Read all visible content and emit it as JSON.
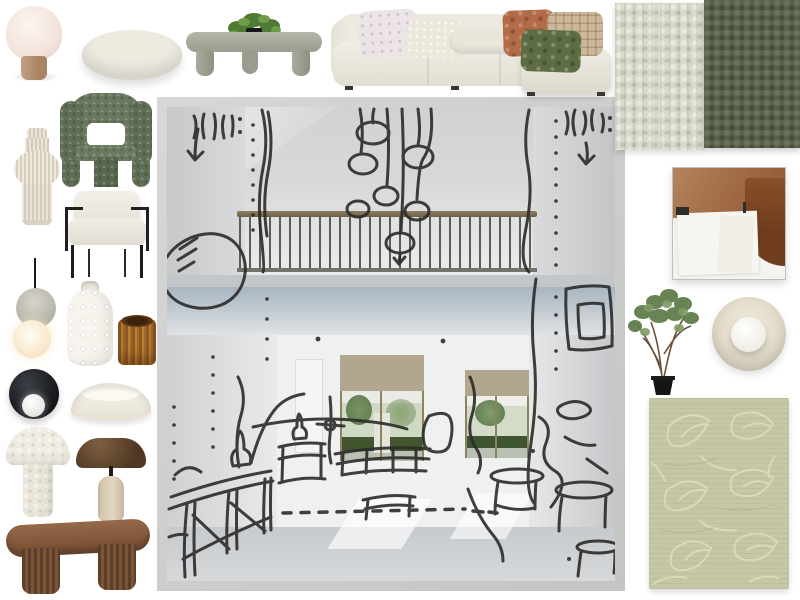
{
  "board": {
    "kind": "interior-design-moodboard-canvas",
    "background": "#ffffff",
    "items": [
      {
        "id": "table-lamp",
        "name": "dome table lamp with wood base",
        "rect": {
          "x": 3,
          "y": 6,
          "w": 62,
          "h": 76
        }
      },
      {
        "id": "ottoman",
        "name": "round boucle ottoman",
        "rect": {
          "x": 82,
          "y": 30,
          "w": 100,
          "h": 50
        }
      },
      {
        "id": "coffee-table",
        "name": "square concrete coffee table with plant",
        "rect": {
          "x": 186,
          "y": 10,
          "w": 136,
          "h": 66
        }
      },
      {
        "id": "sofa",
        "name": "cream modular sofa with cushions and chaise",
        "rect": {
          "x": 331,
          "y": 4,
          "w": 281,
          "h": 92
        }
      },
      {
        "id": "swatch-light",
        "name": "light boucle fabric swatch",
        "rect": {
          "x": 615,
          "y": 3,
          "w": 89,
          "h": 147
        }
      },
      {
        "id": "swatch-olive",
        "name": "olive boucle fabric swatch",
        "rect": {
          "x": 704,
          "y": 0,
          "w": 96,
          "h": 148
        }
      },
      {
        "id": "artwork",
        "name": "abstract framed artwork brown and white",
        "rect": {
          "x": 672,
          "y": 167,
          "w": 112,
          "h": 111
        }
      },
      {
        "id": "tree",
        "name": "potted indoor tree",
        "rect": {
          "x": 621,
          "y": 282,
          "w": 84,
          "h": 114
        }
      },
      {
        "id": "sconce",
        "name": "round cream wall sconce with sphere",
        "rect": {
          "x": 712,
          "y": 297,
          "w": 74,
          "h": 74
        }
      },
      {
        "id": "rug",
        "name": "sage green leaf pattern rug",
        "rect": {
          "x": 649,
          "y": 398,
          "w": 140,
          "h": 191
        }
      },
      {
        "id": "vase-ribbed",
        "name": "cream pleated sculptural vase",
        "rect": {
          "x": 14,
          "y": 128,
          "w": 46,
          "h": 97
        }
      },
      {
        "id": "chair-green",
        "name": "green boucle sculptural armchair",
        "rect": {
          "x": 60,
          "y": 93,
          "w": 92,
          "h": 94
        }
      },
      {
        "id": "chair-white",
        "name": "white armchair with black metal frame",
        "rect": {
          "x": 62,
          "y": 191,
          "w": 90,
          "h": 87
        }
      },
      {
        "id": "pendant",
        "name": "double sphere pendant light",
        "rect": {
          "x": 13,
          "y": 258,
          "w": 44,
          "h": 104
        }
      },
      {
        "id": "vase-dotted",
        "name": "white dotted ceramic vase",
        "rect": {
          "x": 67,
          "y": 281,
          "w": 46,
          "h": 85
        }
      },
      {
        "id": "candle",
        "name": "amber ribbed glass candle holder",
        "rect": {
          "x": 118,
          "y": 315,
          "w": 38,
          "h": 50
        }
      },
      {
        "id": "wall-light-black",
        "name": "black disc wall light with white globe",
        "rect": {
          "x": 9,
          "y": 369,
          "w": 50,
          "h": 50
        }
      },
      {
        "id": "bowl",
        "name": "organic white decorative bowl",
        "rect": {
          "x": 71,
          "y": 379,
          "w": 80,
          "h": 42
        }
      },
      {
        "id": "lamp-mushroom-white",
        "name": "white boucle mushroom lamp",
        "rect": {
          "x": 6,
          "y": 427,
          "w": 64,
          "h": 92
        }
      },
      {
        "id": "lamp-mushroom-brown",
        "name": "bronze mushroom lamp with travertine base",
        "rect": {
          "x": 76,
          "y": 434,
          "w": 70,
          "h": 88
        }
      },
      {
        "id": "bench",
        "name": "walnut fluted oval bench",
        "rect": {
          "x": 6,
          "y": 514,
          "w": 144,
          "h": 82
        }
      },
      {
        "id": "render",
        "name": "double height living room render with marker sketch overlay",
        "rect": {
          "x": 157,
          "y": 97,
          "w": 468,
          "h": 494
        }
      }
    ]
  },
  "palette": {
    "background": "#ffffff",
    "sketch_ink": "#2b2b29",
    "sofa_cream": "#edeae1",
    "swatch_light": "#d9d9cd",
    "swatch_olive": "#59614c",
    "chair_green": "#66755b",
    "terracotta_cushion": "#b26a47",
    "green_cushion": "#5d6c44",
    "amber_glass": "#a06a28",
    "walnut": "#74513a",
    "travertine": "#d9ccb6",
    "rug_sage": "#c6c8a5",
    "photo_grey": "#d5d7d9",
    "blind_tan": "#b2a78e",
    "balustrade_rail": "#84745a",
    "foliage_green": "#5e7a45"
  }
}
